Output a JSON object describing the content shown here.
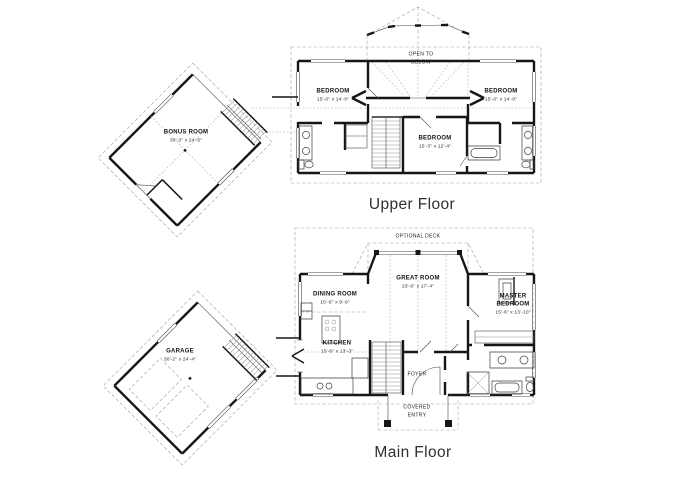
{
  "colors": {
    "background": "#ffffff",
    "wall": "#161616",
    "detail_line": "#9f9f9f",
    "room_text": "#141414",
    "title_text": "#2f2f2f"
  },
  "upper_floor": {
    "title": "Upper Floor",
    "open_to_below": "OPEN TO BELOW",
    "rooms": {
      "bonus": {
        "name": "BONUS ROOM",
        "dims": "30'-3\" x 24'-5\""
      },
      "bedroom_left": {
        "name": "BEDROOM",
        "dims": "15'-0\" x 14'-0\""
      },
      "bedroom_right": {
        "name": "BEDROOM",
        "dims": "15'-0\" x 14'-0\""
      },
      "bedroom_middle": {
        "name": "BEDROOM",
        "dims": "15'-3\" x 12'-4\""
      }
    }
  },
  "main_floor": {
    "title": "Main Floor",
    "optional_deck": "OPTIONAL DECK",
    "rooms": {
      "garage": {
        "name": "GARAGE",
        "dims": "30'-2\" x 24'-4\""
      },
      "dining": {
        "name": "DINING ROOM",
        "dims": "15'-6\" x 9'-6\""
      },
      "great": {
        "name": "GREAT ROOM",
        "dims": "23'-6\" x 17'-4\""
      },
      "master": {
        "name": "MASTER BEDROOM",
        "dims": "15'-6\" x 13'-10\""
      },
      "kitchen": {
        "name": "KITCHEN",
        "dims": "15'-6\" x 13'-3\""
      },
      "foyer": {
        "name": "FOYER"
      },
      "covered_entry": {
        "name": "COVERED ENTRY"
      }
    }
  }
}
